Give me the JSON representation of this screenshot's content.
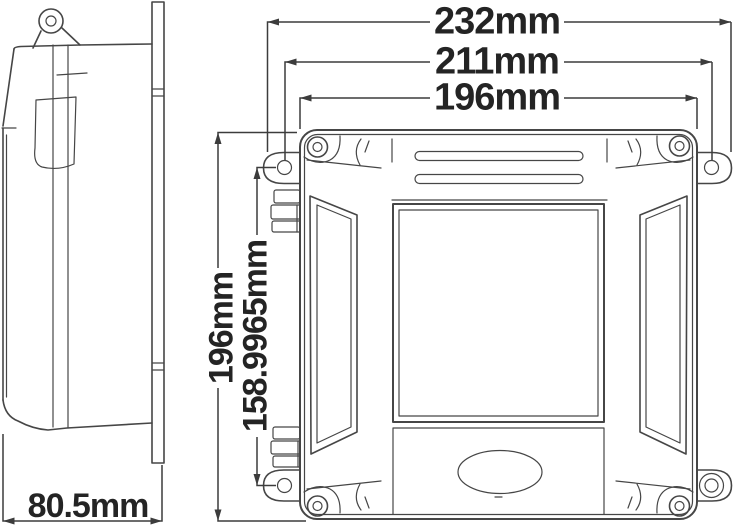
{
  "drawing": {
    "type": "technical-dimension-drawing",
    "background": "#ffffff",
    "line_color": "#464646",
    "text_color": "#242424",
    "views": {
      "side_view": "enclosure-side-profile",
      "front_view": "enclosure-front-face"
    },
    "dimensions": {
      "overall_width": "232mm",
      "mounting_hole_spacing_width": "211mm",
      "body_width": "196mm",
      "body_height": "196mm",
      "mounting_hole_spacing_height": "158.9965mm",
      "depth": "80.5mm"
    }
  }
}
